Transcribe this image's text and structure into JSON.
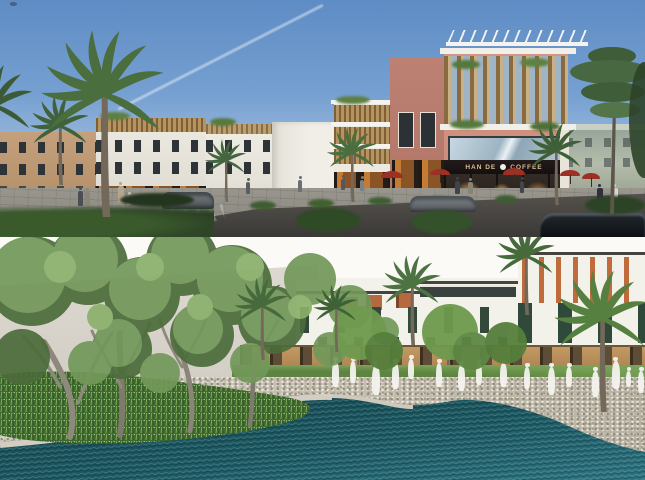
{
  "image": {
    "kind": "architectural-rendering-collage",
    "panels": [
      {
        "id": "street-view",
        "content": "row of 4-storey shophouses with wood-slat screens, salmon corner cafe building, palm trees, street with cars, people and red umbrellas under blue sky"
      },
      {
        "id": "pool-landscape",
        "content": "resort pool with planted island and large tree, pebble deck with white ghost figures, white townhouses with green panels and palms under white sky"
      }
    ]
  },
  "signage": {
    "cafe_left": "HAN DE",
    "cafe_right": "COFFEE"
  },
  "palette": {
    "sky_top": "#5e8cc4",
    "sky_horizon": "#c2d5ea",
    "salmon_facade": "#d09181",
    "wood_slat": "#b6945f",
    "white_facade": "#efeee8",
    "road": "#47443f",
    "pool_deep": "#16464e",
    "pool_light": "#2e7683",
    "pebble_deck": "#c6c0b2",
    "grass_island": "#4e7a36",
    "umbrella_red": "#9c3024",
    "ghost_figure": "#f4f3ee"
  }
}
